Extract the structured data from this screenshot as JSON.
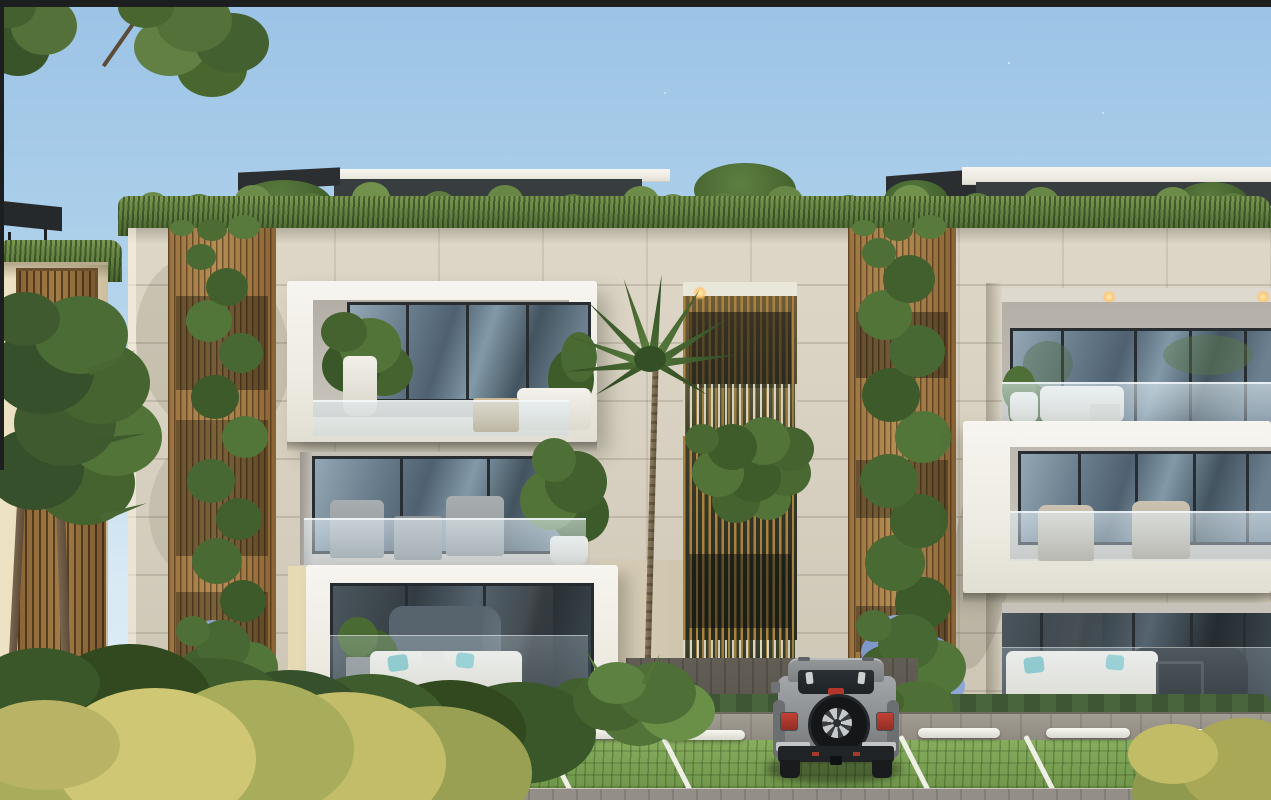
{
  "scene_type": "architectural exterior rendering, modern residential building, daytime",
  "visible_text": [],
  "sky": {
    "top_color": "#9cc3e6",
    "horizon_color": "#e3f0f7",
    "condition": "clear with faint wisps"
  },
  "building": {
    "storeys_visible": 3,
    "facade": {
      "material": "travertine stone panels",
      "color": "#d6cfbf"
    },
    "balcony_boxes": {
      "frame_color": "#f4f2ec",
      "railing_type": "frameless glass",
      "count_left_stack": 3,
      "count_right_wing": 3
    },
    "windows": {
      "frame_color": "#282d31",
      "glass_tint": "#5f7383"
    },
    "wood_louver_columns": {
      "count": 3,
      "color": "#a87e46",
      "planting": "climbing vines with blue plumbago flowers"
    },
    "center_bay": {
      "type": "slatted green-wall bay",
      "planting": "white pampas plumes and cascading greenery",
      "downlight_on": true
    },
    "green_roof": {
      "grass_color": "#5e7c3e",
      "pergola_color": "#2b2e30",
      "parapet_color": "#f1f0ea"
    },
    "balcony_furniture": [
      "white lounge sofa with cushions",
      "gray dining chairs and table",
      "wicker armchairs",
      "white planters with ficus and fan plants",
      "sofa with teal pillows"
    ]
  },
  "neighbor_building_left": {
    "wall_color": "#e8ddbe",
    "wood_fence_color": "#8a6436",
    "palms": 2,
    "pergola_color": "#26292b"
  },
  "landscaping": {
    "center_palm": {
      "foliage_color": "#466430",
      "trunk_color": "#7d6c52"
    },
    "hedge_color": "#435c38",
    "foreground_bush_colors": [
      "#c3bc68",
      "#cfc773",
      "#9aa053"
    ],
    "fern_bush_position": "left of entrance walkway"
  },
  "parking": {
    "surface": "grass block pavers",
    "grass_color": "#7ca452",
    "stall_line_color": "#eef0e6",
    "wheel_stop_color": "#f1f0ea",
    "wheel_stops_visible": 8,
    "sidewalk_color": "#9a958b",
    "entrance_walkway_color": "#57534b"
  },
  "vehicle": {
    "type": "SUV seen from rear (Wrangler-style)",
    "body_color": "#8f9294",
    "features": [
      "rear-mounted spare tire with silver alloy wheel",
      "red taillights",
      "black rear bumper with silver ends",
      "high-mount brake light",
      "dark tinted rear window",
      "roof rails"
    ]
  },
  "image_border": {
    "top_bar_color": "#1c1e20",
    "left_bar_color": "#1c1e20"
  }
}
